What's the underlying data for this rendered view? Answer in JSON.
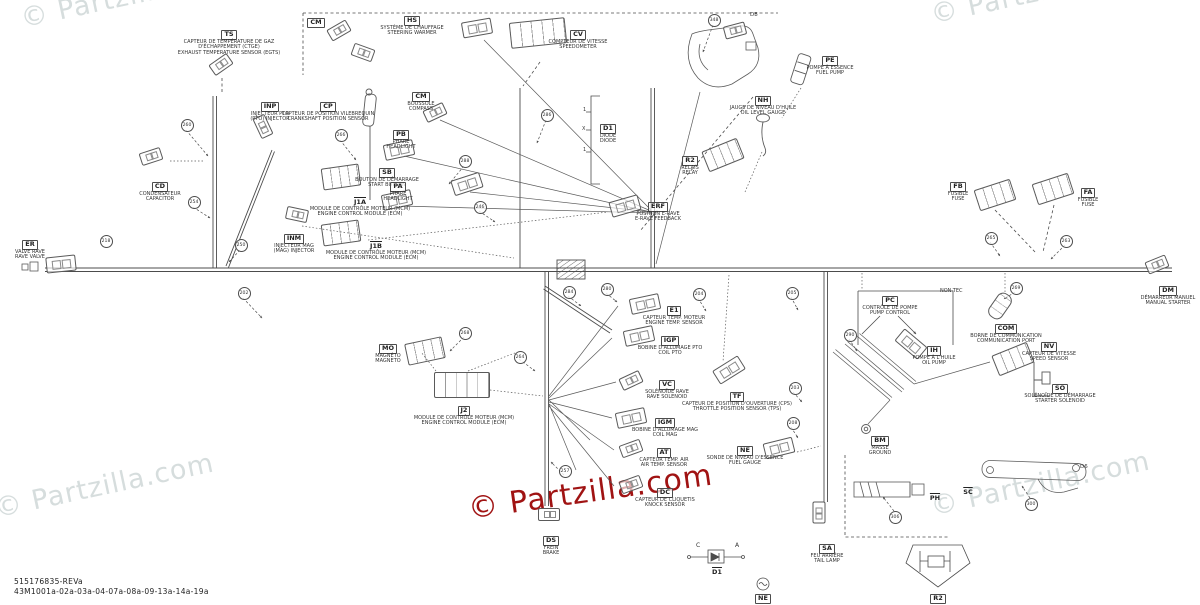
{
  "footer": {
    "line1": "515176835-REVa",
    "line2": "43M1001a-02a-03a-04-07a-08a-09-13a-14a-19a"
  },
  "watermarks": [
    {
      "text": "© Partzilla.com",
      "x": 18,
      "y": 4,
      "r": -12,
      "c": "gray"
    },
    {
      "text": "© Partzilla.com",
      "x": 928,
      "y": 0,
      "r": -12,
      "c": "gray"
    },
    {
      "text": "© Partzilla.com",
      "x": -8,
      "y": 494,
      "r": -12,
      "c": "gray"
    },
    {
      "text": "© Partzilla.com",
      "x": 928,
      "y": 492,
      "r": -12,
      "c": "gray"
    },
    {
      "text": "© Partzilla.com",
      "x": 466,
      "y": 492,
      "r": -8,
      "c": "red"
    }
  ],
  "components": [
    {
      "code": "TS",
      "fr": "CAPTEUR DE TEMPÉRATURE DE GAZ D'ÉCHAPPEMENT (CTGE)",
      "en": "EXHAUST TEMPERATURE SENSOR (EGTS)",
      "x": 229,
      "y": 28,
      "w": 130,
      "icon": {
        "t": "plug",
        "x": 210,
        "y": 58,
        "r": -35
      }
    },
    {
      "code": "HS",
      "fr": "SYSTÈME DE CHAUFFAGE",
      "en": "STEERING WARMER",
      "x": 412,
      "y": 14,
      "w": 78,
      "icon": {
        "t": "pluglg",
        "x": 462,
        "y": 20,
        "r": -10
      }
    },
    {
      "code": "SB",
      "fr": "BOUTON DE DÉMARRAGE",
      "en": "START BUTTON",
      "x": 387,
      "y": 166,
      "w": 80,
      "icon": {
        "t": "pluglg",
        "x": 452,
        "y": 176,
        "r": -18
      }
    },
    {
      "code": "CM",
      "fr": "BOUSSOLE",
      "en": "COMPASS",
      "x": 421,
      "y": 90,
      "w": 60,
      "icon": {
        "t": "plug",
        "x": 424,
        "y": 106,
        "r": -25
      }
    },
    {
      "code": "PB",
      "fr": "PHARE",
      "en": "HEADLIGHT",
      "x": 401,
      "y": 128,
      "w": 50,
      "icon": {
        "t": "pluglg",
        "x": 384,
        "y": 142,
        "r": -12
      }
    },
    {
      "code": "PA",
      "fr": "PHARE",
      "en": "HEADLIGHT",
      "x": 398,
      "y": 180,
      "w": 50,
      "icon": {
        "t": "pluglg",
        "x": 382,
        "y": 192,
        "r": -12
      }
    },
    {
      "code": "INP",
      "fr": "INJECTEUR PTO",
      "en": "(PTO) INJECTOR",
      "x": 270,
      "y": 100,
      "w": 70,
      "icon": {
        "t": "plug",
        "x": 252,
        "y": 120,
        "r": 65
      }
    },
    {
      "code": "CP",
      "fr": "CAPTEUR DE POSITION VILEBREQUIN",
      "en": "CRANKSHAFT POSITION SENSOR",
      "x": 328,
      "y": 100,
      "w": 105
    },
    {
      "code": "CD",
      "fr": "CONDENSATEUR",
      "en": "CAPACITOR",
      "x": 160,
      "y": 180,
      "w": 70,
      "icon": {
        "t": "plug",
        "x": 140,
        "y": 150,
        "r": -18
      }
    },
    {
      "code": "ER",
      "fr": "VALVE RAVE",
      "en": "RAVE VALVE",
      "x": 30,
      "y": 238,
      "w": 52,
      "icon": {
        "t": "pluglg",
        "x": 46,
        "y": 256,
        "r": -6
      }
    },
    {
      "code": "INM",
      "fr": "INJECTEUR MAG",
      "en": "(MAG) INJECTOR",
      "x": 294,
      "y": 232,
      "w": 72,
      "icon": {
        "t": "plug",
        "x": 286,
        "y": 208,
        "r": 12
      }
    },
    {
      "code": "J1A",
      "fr": "MODULE DE CONTRÔLE MOTEUR (MCM)",
      "en": "ENGINE CONTROL MODULE (ECM)",
      "x": 360,
      "y": 196,
      "w": 110,
      "box": false,
      "icon": {
        "t": "module",
        "x": 322,
        "y": 166,
        "r": -8
      }
    },
    {
      "code": "J1B",
      "fr": "MODULE DE CONTRÔLE MOTEUR (MCM)",
      "en": "ENGINE CONTROL MODULE (ECM)",
      "x": 376,
      "y": 240,
      "w": 110,
      "box": false,
      "icon": {
        "t": "module",
        "x": 322,
        "y": 222,
        "r": -8
      }
    },
    {
      "code": "CV",
      "fr": "COMPTEUR DE VITESSE",
      "en": "SPEEDOMETER",
      "x": 578,
      "y": 28,
      "w": 70,
      "icon": {
        "t": "modulelg",
        "x": 510,
        "y": 20,
        "r": -6
      }
    },
    {
      "code": "D1",
      "fr": "DIODE",
      "en": "DIODE",
      "x": 608,
      "y": 122,
      "w": 40
    },
    {
      "code": "NH",
      "fr": "JAUGE DE NIVEAU D'HUILE",
      "en": "OIL LEVEL GAUGE",
      "x": 763,
      "y": 94,
      "w": 80
    },
    {
      "code": "PE",
      "fr": "POMPE À ESSENCE",
      "en": "FUEL PUMP",
      "x": 830,
      "y": 54,
      "w": 60
    },
    {
      "code": "R2",
      "fr": "RELAIS",
      "en": "RELAY",
      "x": 690,
      "y": 154,
      "w": 50,
      "icon": {
        "t": "module",
        "x": 704,
        "y": 144,
        "r": -22
      }
    },
    {
      "code": "ERF",
      "fr": "POSITION E-RAVE",
      "en": "E-RAVE FEEDBACK",
      "x": 658,
      "y": 200,
      "w": 74,
      "icon": {
        "t": "pluglg",
        "x": 610,
        "y": 198,
        "r": -16
      }
    },
    {
      "code": "FB",
      "fr": "FUSIBLE",
      "en": "FUSE",
      "x": 958,
      "y": 180,
      "w": 40,
      "icon": {
        "t": "module",
        "x": 976,
        "y": 184,
        "r": -18
      }
    },
    {
      "code": "FA",
      "fr": "FUSIBLE",
      "en": "FUSE",
      "x": 1088,
      "y": 186,
      "w": 40,
      "icon": {
        "t": "module",
        "x": 1034,
        "y": 178,
        "r": -18
      }
    },
    {
      "code": "DM",
      "fr": "DÉMARREUR MANUEL",
      "en": "MANUAL STARTER",
      "x": 1168,
      "y": 284,
      "w": 60,
      "icon": {
        "t": "plug",
        "x": 1146,
        "y": 258,
        "r": -22
      }
    },
    {
      "code": "COM",
      "fr": "BORNE DE COMMUNICATION",
      "en": "COMMUNICATION PORT",
      "x": 1006,
      "y": 322,
      "w": 100,
      "icon": {
        "t": "cyl",
        "x": 992,
        "y": 292,
        "r": 35
      }
    },
    {
      "code": "PC",
      "fr": "CONTRÔLE DE POMPE",
      "en": "PUMP CONTROL",
      "x": 890,
      "y": 294,
      "w": 64
    },
    {
      "code": "IH",
      "fr": "POMPE À L'HUILE",
      "en": "OIL PUMP",
      "x": 934,
      "y": 344,
      "w": 64,
      "icon": {
        "t": "pluglg",
        "x": 896,
        "y": 336,
        "r": 40
      }
    },
    {
      "code": "NV",
      "fr": "CAPTEUR DE VITESSE",
      "en": "SPEED SENSOR",
      "x": 1049,
      "y": 340,
      "w": 70,
      "icon": {
        "t": "module",
        "x": 994,
        "y": 348,
        "r": -22
      }
    },
    {
      "code": "SO",
      "fr": "SOLÉNOÏDE DE DÉMARRAGE",
      "en": "STARTER SOLENOID",
      "x": 1060,
      "y": 382,
      "w": 80
    },
    {
      "code": "MO",
      "fr": "MAGNÉTO",
      "en": "MAGNETO",
      "x": 388,
      "y": 342,
      "w": 50,
      "icon": {
        "t": "module",
        "x": 406,
        "y": 340,
        "r": -12
      }
    },
    {
      "code": "J2",
      "fr": "MODULE DE CONTRÔLE MOTEUR (MCM)",
      "en": "ENGINE CONTROL MODULE (ECM)",
      "x": 464,
      "y": 404,
      "w": 120,
      "icon": {
        "t": "modulelg",
        "x": 434,
        "y": 372,
        "r": 0
      }
    },
    {
      "code": "E1",
      "fr": "CAPTEUR TEMP. MOTEUR",
      "en": "ENGINE TEMP. SENSOR",
      "x": 674,
      "y": 304,
      "w": 80,
      "icon": {
        "t": "pluglg",
        "x": 630,
        "y": 296,
        "r": -12
      }
    },
    {
      "code": "IGP",
      "fr": "BOBINE D'ALLUMAGE PTO",
      "en": "COIL PTO",
      "x": 670,
      "y": 334,
      "w": 80,
      "icon": {
        "t": "pluglg",
        "x": 624,
        "y": 328,
        "r": -12
      }
    },
    {
      "code": "VC",
      "fr": "SOLÉNOÏDE RAVE",
      "en": "RAVE SOLENOID",
      "x": 667,
      "y": 378,
      "w": 74,
      "icon": {
        "t": "plug",
        "x": 620,
        "y": 374,
        "r": -25
      }
    },
    {
      "code": "IGM",
      "fr": "BOBINE D'ALLUMAGE MAG",
      "en": "COIL MAG",
      "x": 665,
      "y": 416,
      "w": 82,
      "icon": {
        "t": "pluglg",
        "x": 616,
        "y": 410,
        "r": -12
      }
    },
    {
      "code": "AT",
      "fr": "CAPTEUR TEMP. AIR",
      "en": "AIR TEMP. SENSOR",
      "x": 664,
      "y": 446,
      "w": 74,
      "icon": {
        "t": "plug",
        "x": 620,
        "y": 442,
        "r": -20
      }
    },
    {
      "code": "DC",
      "fr": "CAPTEUR DE CLIQUETIS",
      "en": "KNOCK SENSOR",
      "x": 665,
      "y": 486,
      "w": 80,
      "icon": {
        "t": "plug",
        "x": 620,
        "y": 478,
        "r": -20
      }
    },
    {
      "code": "TF",
      "fr": "CAPTEUR DE POSITION D'OUVERTURE (CPS)",
      "en": "THROTTLE POSITION SENSOR (TPS)",
      "x": 737,
      "y": 390,
      "w": 128,
      "icon": {
        "t": "pluglg",
        "x": 714,
        "y": 362,
        "r": -32
      }
    },
    {
      "code": "NE",
      "fr": "SONDE DE NIVEAU D'ESSENCE",
      "en": "FUEL GAUGE",
      "x": 745,
      "y": 444,
      "w": 78,
      "icon": {
        "t": "pluglg",
        "x": 764,
        "y": 440,
        "r": -14
      }
    },
    {
      "code": "BM",
      "fr": "MASSE",
      "en": "GROUND",
      "x": 880,
      "y": 434,
      "w": 44
    },
    {
      "code": "SA",
      "fr": "FEU ARRIÈRE",
      "en": "TAIL LAMP",
      "x": 827,
      "y": 542,
      "w": 56,
      "icon": {
        "t": "plug",
        "x": 808,
        "y": 506,
        "r": 90
      }
    },
    {
      "code": "DS",
      "fr": "FREIN",
      "en": "BRAKE",
      "x": 551,
      "y": 534,
      "w": 44,
      "icon": {
        "t": "plug",
        "x": 538,
        "y": 508,
        "r": 0
      }
    },
    {
      "code": "SC",
      "x": 968,
      "y": 486,
      "w": 24,
      "box": false
    },
    {
      "code": "PH",
      "x": 935,
      "y": 492,
      "w": 24,
      "box": false
    },
    {
      "code": "R2",
      "x": 938,
      "y": 592,
      "w": 24
    },
    {
      "code": "D1",
      "x": 717,
      "y": 566,
      "w": 24,
      "box": false
    },
    {
      "code": "NE",
      "x": 763,
      "y": 592,
      "w": 24
    },
    {
      "code": "CM",
      "x": 316,
      "y": 16,
      "w": 24
    }
  ],
  "misc_icons": [
    {
      "t": "plug",
      "x": 328,
      "y": 24,
      "r": -30
    },
    {
      "t": "plug",
      "x": 352,
      "y": 46,
      "r": 20
    },
    {
      "t": "plug",
      "x": 724,
      "y": 24,
      "r": -15
    }
  ],
  "circles": [
    {
      "n": "260",
      "x": 186,
      "y": 124
    },
    {
      "n": "254",
      "x": 193,
      "y": 201
    },
    {
      "n": "250",
      "x": 240,
      "y": 244
    },
    {
      "n": "202",
      "x": 243,
      "y": 292
    },
    {
      "n": "218",
      "x": 105,
      "y": 240
    },
    {
      "n": "266",
      "x": 340,
      "y": 134
    },
    {
      "n": "286",
      "x": 546,
      "y": 114
    },
    {
      "n": "288",
      "x": 464,
      "y": 160
    },
    {
      "n": "246",
      "x": 479,
      "y": 206
    },
    {
      "n": "268",
      "x": 464,
      "y": 332
    },
    {
      "n": "264",
      "x": 519,
      "y": 356
    },
    {
      "n": "284",
      "x": 568,
      "y": 291
    },
    {
      "n": "280",
      "x": 606,
      "y": 288
    },
    {
      "n": "257",
      "x": 564,
      "y": 470
    },
    {
      "n": "204",
      "x": 698,
      "y": 293
    },
    {
      "n": "205",
      "x": 791,
      "y": 292
    },
    {
      "n": "203",
      "x": 794,
      "y": 387
    },
    {
      "n": "208",
      "x": 792,
      "y": 422
    },
    {
      "n": "290",
      "x": 849,
      "y": 334
    },
    {
      "n": "348",
      "x": 713,
      "y": 19
    },
    {
      "n": "265",
      "x": 990,
      "y": 237
    },
    {
      "n": "263",
      "x": 1065,
      "y": 240
    },
    {
      "n": "269",
      "x": 1015,
      "y": 287
    },
    {
      "n": "306",
      "x": 894,
      "y": 516
    },
    {
      "n": "300",
      "x": 1030,
      "y": 503
    }
  ],
  "notes": [
    {
      "text": "NON-TEC",
      "x": 940,
      "y": 288,
      "s": 5
    },
    {
      "text": "D8",
      "x": 750,
      "y": 12,
      "s": 5.5
    },
    {
      "text": "D6",
      "x": 1080,
      "y": 464,
      "s": 5.5
    },
    {
      "text": "C",
      "x": 696,
      "y": 542,
      "s": 6
    },
    {
      "text": "A",
      "x": 735,
      "y": 542,
      "s": 6
    },
    {
      "text": "1",
      "x": 583,
      "y": 107,
      "s": 5
    },
    {
      "text": "X",
      "x": 582,
      "y": 126,
      "s": 5
    },
    {
      "text": "1",
      "x": 583,
      "y": 147,
      "s": 5
    }
  ]
}
